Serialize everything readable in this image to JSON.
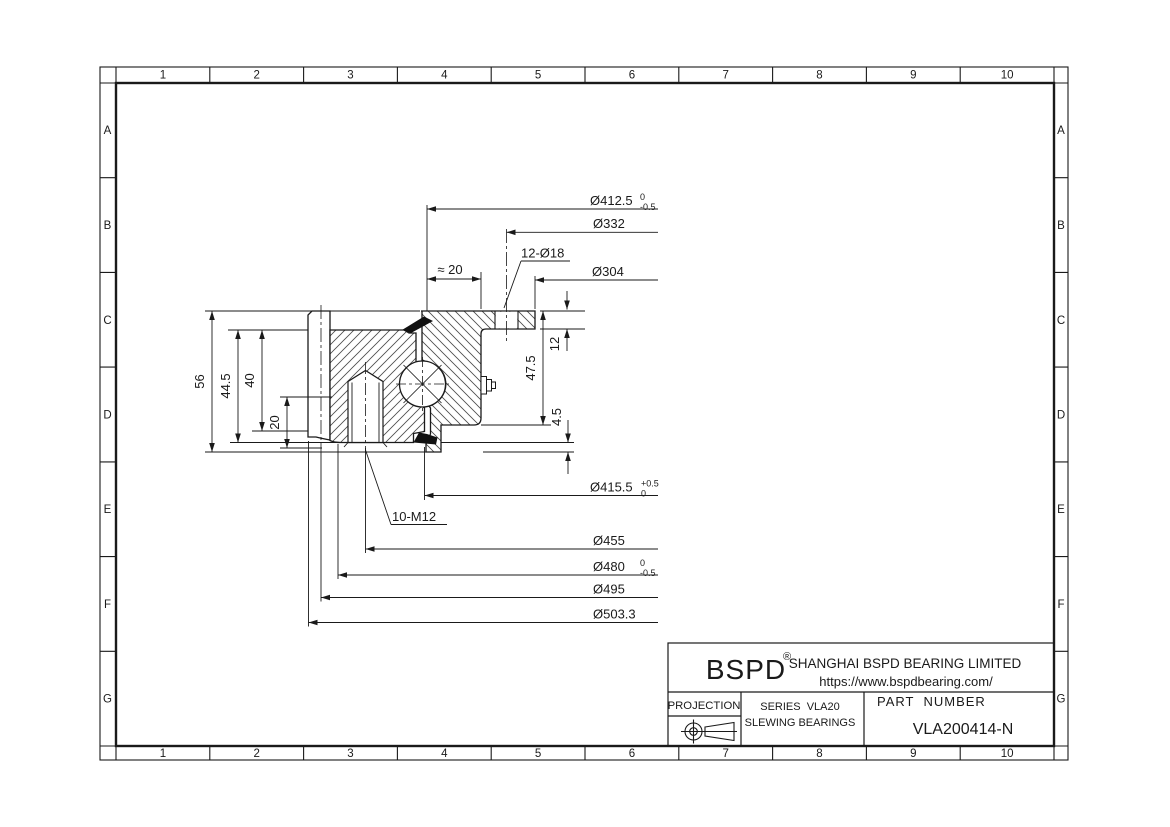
{
  "grid": {
    "columns": [
      "1",
      "2",
      "3",
      "4",
      "5",
      "6",
      "7",
      "8",
      "9",
      "10"
    ],
    "rows": [
      "A",
      "B",
      "C",
      "D",
      "E",
      "F",
      "G"
    ]
  },
  "dimensions": {
    "top": [
      {
        "label": "Ø412.5",
        "tol_top": "0",
        "tol_bottom": "-0.5"
      },
      {
        "label": "Ø332"
      },
      {
        "label": "12-Ø18"
      },
      {
        "label": "Ø304"
      },
      {
        "label": "≈ 20"
      }
    ],
    "left": [
      {
        "label": "56"
      },
      {
        "label": "44.5"
      },
      {
        "label": "40"
      },
      {
        "label": "20"
      }
    ],
    "right": [
      {
        "label": "12"
      },
      {
        "label": "47.5"
      },
      {
        "label": "4.5"
      }
    ],
    "bottom": [
      {
        "label": "Ø415.5",
        "tol_top": "+0.5",
        "tol_bottom": "0"
      },
      {
        "label": "10-M12"
      },
      {
        "label": "Ø455"
      },
      {
        "label": "Ø480",
        "tol_top": "0",
        "tol_bottom": "-0.5"
      },
      {
        "label": "Ø495"
      },
      {
        "label": "Ø503.3"
      }
    ]
  },
  "title_block": {
    "brand": "BSPD",
    "reg_mark": "®",
    "company": "SHANGHAI BSPD BEARING LIMITED",
    "website": "https://www.bspdbearing.com/",
    "projection_label": "PROJECTION",
    "series_line1": "SERIES  VLA20",
    "series_line2": "SLEWING BEARINGS",
    "part_number_label": "PART  NUMBER",
    "part_number": "VLA200414-N"
  },
  "colors": {
    "line": "#1a1a1a",
    "seal_fill": "#111111",
    "background": "#ffffff"
  }
}
